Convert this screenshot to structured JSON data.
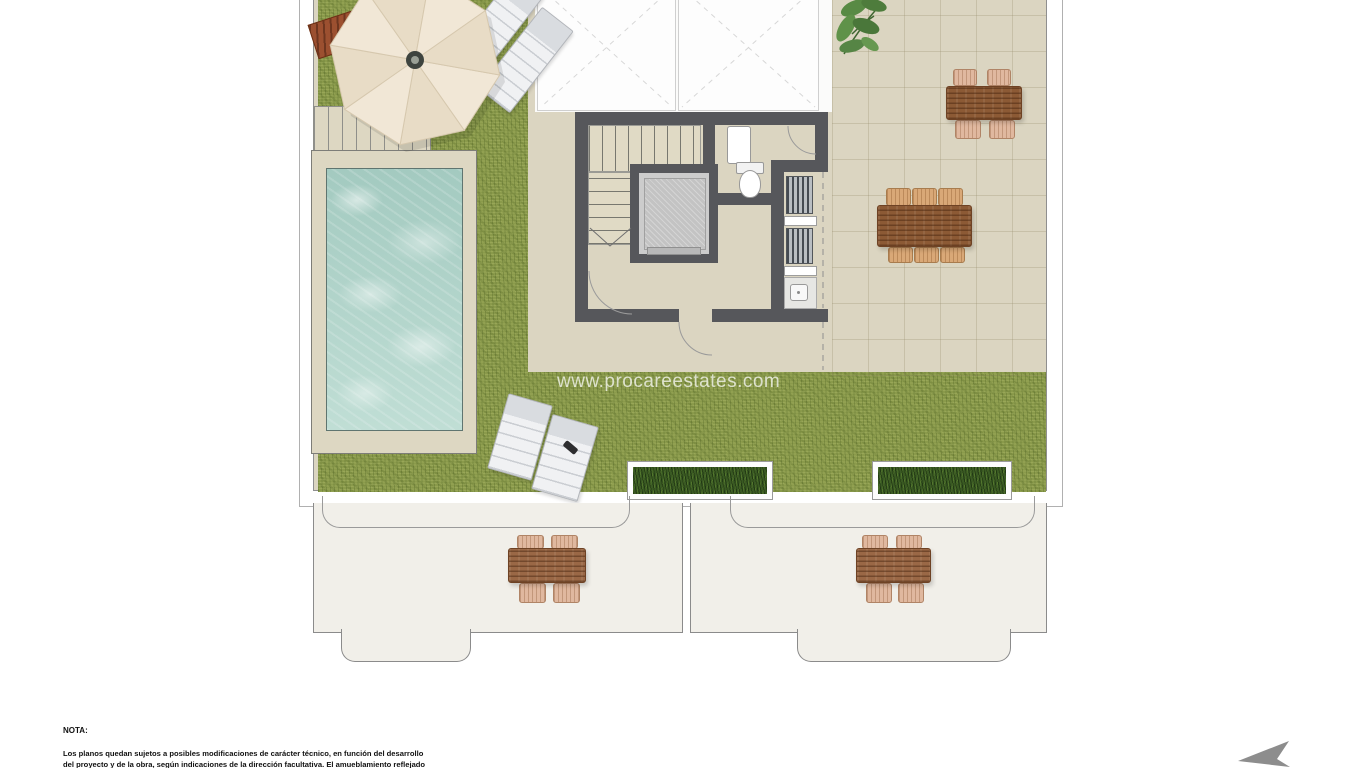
{
  "watermark": {
    "text": "www.procareestates.com"
  },
  "note": {
    "label": "NOTA:",
    "line1": "Los planos quedan sujetos a posibles modificaciones de carácter técnico, en función del desarrollo",
    "line2": "del proyecto y de la obra, según indicaciones de la dirección facultativa. El amueblamiento reflejado"
  },
  "icons": {
    "north_arrow": "north-arrow-icon",
    "umbrella": "parasol-icon",
    "plant": "plant-icon"
  },
  "palette": {
    "grass": "#8a9a4b",
    "terrace_tile": "#dbd5c1",
    "wall": "#56575b",
    "pool_water": "#b7d8cf",
    "pool_deck": "#ddd7c2",
    "table_wood": "#8c5a35",
    "lower_terrace": "#f1efe9",
    "planter_green": "#3a5a23",
    "compass_gray": "#8d8d8d",
    "watermark_color": "rgba(255,255,255,0.72)"
  }
}
